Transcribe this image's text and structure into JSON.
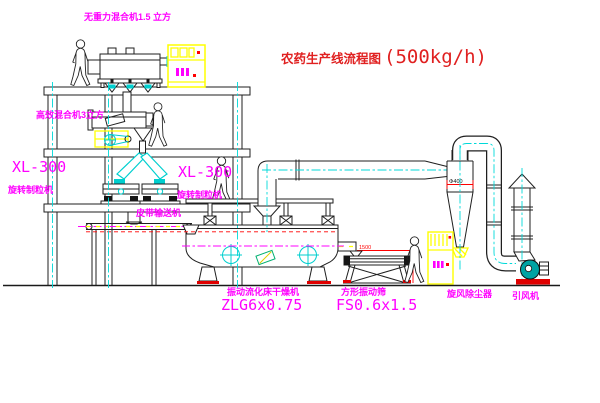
{
  "title": {
    "text_cn": "农药生产线流程图",
    "capacity": "(500kg/h)"
  },
  "equipment_labels": {
    "zero_gravity_mixer": "无重力混合机1.5 立方",
    "high_efficiency_mixer": "高效混合机3立方",
    "granulator_left_model": "XL-300",
    "granulator_left_name": "旋转制粒机",
    "granulator_right_model": "XL-300",
    "granulator_right_name": "旋转制粒机",
    "belt_conveyor": "皮带输送机",
    "fluid_bed_dryer_name": "振动流化床干燥机",
    "fluid_bed_dryer_model": "ZLG6x0.75",
    "square_sieve_name": "方形振动筛",
    "square_sieve_model": "FS0.6x1.5",
    "cyclone_dust_collector": "旋风除尘器",
    "induced_draft_fan": "引风机"
  },
  "dimensions": {
    "cyclone_diameter": "Φ400",
    "sieve_feed_length": "1500"
  },
  "colors": {
    "label_magenta": "#FF00FF",
    "title_red": "#E02020",
    "dimension_red": "#FF0000",
    "cad_yellow": "#FFFF00",
    "cad_cyan": "#00CFCF",
    "fan_teal": "#00A3A3",
    "line_black": "#1F1F1F",
    "background": "#FFFFFF"
  }
}
